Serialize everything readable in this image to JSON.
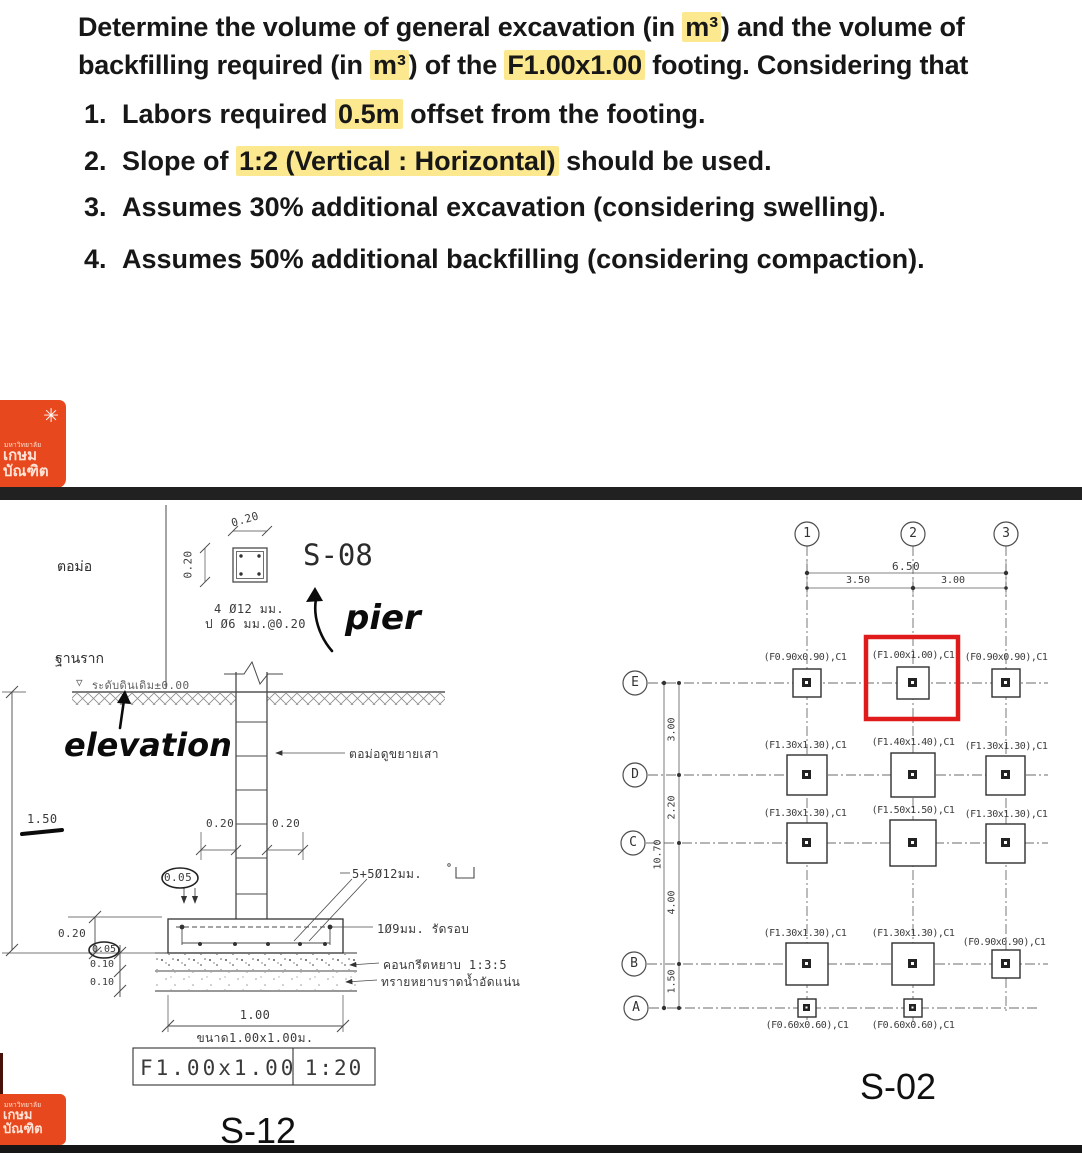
{
  "question": {
    "l1": [
      {
        "t": "Determine the volume of general excavation (in "
      },
      {
        "t": "m³",
        "h": 1
      },
      {
        "t": ") and the volume of"
      }
    ],
    "l2": [
      {
        "t": "backfilling required (in "
      },
      {
        "t": "m³",
        "h": 1
      },
      {
        "t": ") of the "
      },
      {
        "t": "F1.00x1.00",
        "h": 1
      },
      {
        "t": " footing. Considering that"
      }
    ],
    "items": [
      {
        "n": "1.",
        "segs": [
          {
            "t": "Labors required "
          },
          {
            "t": "0.5m",
            "h": 1
          },
          {
            "t": " offset from the footing."
          }
        ]
      },
      {
        "n": "2.",
        "segs": [
          {
            "t": "Slope of "
          },
          {
            "t": "1:2 (Vertical : Horizontal)",
            "h": 1
          },
          {
            "t": " should be used."
          }
        ]
      },
      {
        "n": "3.",
        "segs": [
          {
            "t": "Assumes 30% additional excavation (considering swelling)."
          }
        ]
      },
      {
        "n": "4.",
        "segs": [
          {
            "t": "Assumes 50% additional backfilling (considering compaction)."
          }
        ]
      }
    ]
  },
  "logo": {
    "star": "✳",
    "university": "มหาวิทยาลัย",
    "name1": "เกษม",
    "name2": "บัณฑิต"
  },
  "s12": {
    "pier_th": "ตอม่อ",
    "footing_th": "ฐานราก",
    "detail_ref": "S-08",
    "pier_dim_top": "0.20",
    "pier_dim_left": "0.20",
    "pier_rebar": "4 Ø12 มม.",
    "pier_stirrup": "ป Ø6 มม.@0.20",
    "hand_pier": "pier",
    "hand_elevation": "elevation",
    "ground_marker": "▽",
    "ground_level": "ระดับดินเดิม±0.00",
    "column_note": "ตอม่อดูขยายเสา",
    "dim_020_col_left": "0.20",
    "dim_020_col_right": "0.20",
    "dim_005_col": "0.05",
    "footing_rebar": "5+5Ø12มม.",
    "perimeter_tie": "1Ø9มม. รัดรอบ",
    "lean_concrete": "คอนกรีตหยาบ 1:3:5",
    "sand_layer": "ทรายหยาบราดน้ำอัดแน่น",
    "dim_150": "1.50",
    "dim_020": "0.20",
    "dim_005": "0.05",
    "dim_010a": "0.10",
    "dim_010b": "0.10",
    "dim_100": "1.00",
    "size_note": "ขนาด1.00x1.00ม.",
    "title_name": "F1.00x1.00",
    "title_scale": "1:20",
    "sheet": "S-12"
  },
  "s02": {
    "sheet": "S-02",
    "grid_cols": [
      "1",
      "2",
      "3"
    ],
    "grid_rows": [
      "E",
      "D",
      "C",
      "B",
      "A"
    ],
    "dims": {
      "total_width": "6.50",
      "span_12": "3.50",
      "span_23": "3.00",
      "span_ed": "3.00",
      "span_dc": "2.20",
      "total_height": "10.70",
      "span_cb": "4.00",
      "span_ba": "1.50"
    },
    "footings": [
      "(F0.90x0.90),C1",
      "(F1.00x1.00),C1",
      "(F0.90x0.90),C1",
      "(F1.30x1.30),C1",
      "(F1.40x1.40),C1",
      "(F1.30x1.30),C1",
      "(F1.30x1.30),C1",
      "(F1.50x1.50),C1",
      "(F1.30x1.30),C1",
      "(F1.30x1.30),C1",
      "(F1.30x1.30),C1",
      "(F0.90x0.90),C1",
      "(F0.60x0.60),C1",
      "(F0.60x0.60),C1"
    ],
    "highlight_color": "#e01b1b"
  },
  "colors": {
    "logo": "#e8481e",
    "highlight": "#fbe88f",
    "divider_bar": "#212121"
  }
}
